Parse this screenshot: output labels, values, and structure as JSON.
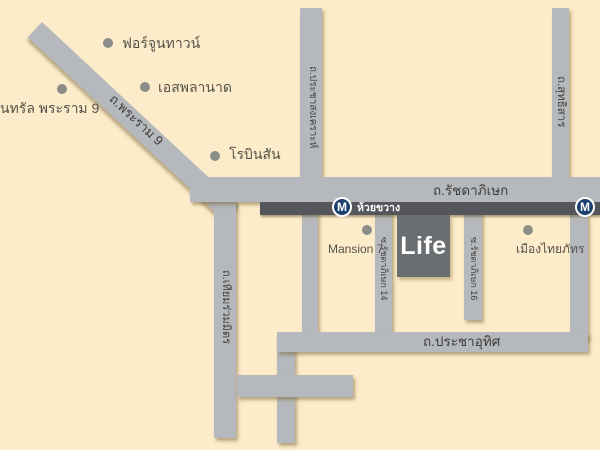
{
  "map": {
    "colors": {
      "background": "#fcecca",
      "road": "#b5b8bc",
      "mrt_band": "#55565b",
      "mrt_circle": "#1b3f6e",
      "life_block": "#6a6e71",
      "poi_dot": "#8c8c88",
      "label_dark": "#45443d",
      "label_on_road": "#3e3d38",
      "white": "#ffffff"
    },
    "roads": {
      "rama9": {
        "label": "ถ.พระราม 9"
      },
      "ratchadaphisek": {
        "label": "ถ.รัชดาภิเษก"
      },
      "pracha_songkhro": {
        "label": "ถ.ประชาสงเคราะห์"
      },
      "sutthisan": {
        "label": "ถ.สุทธิสาร"
      },
      "thiam_ruam_mit": {
        "label": "ถ.เทียมร่วมมิตร"
      },
      "soi_ratchada_14": {
        "label": "ซ.รัชดาภิเษก 14"
      },
      "soi_ratchada_16": {
        "label": "ซ.รัชดาภิเษก 16"
      },
      "pracha_uthit": {
        "label": "ถ.ประชาอุทิศ"
      }
    },
    "mrt": {
      "logo_letter": "M",
      "stations": [
        {
          "name": "ห้วยขวาง"
        },
        {
          "name": "ส"
        }
      ]
    },
    "project": {
      "name": "Life"
    },
    "pois": [
      {
        "label": "ฟอร์จูนทาวน์"
      },
      {
        "label": "เอสพลานาด"
      },
      {
        "label": "นทรัล พระราม 9"
      },
      {
        "label": "โรบินสัน"
      },
      {
        "label": "Mansion 7"
      },
      {
        "label": "เมืองไทยภัทร"
      }
    ]
  }
}
